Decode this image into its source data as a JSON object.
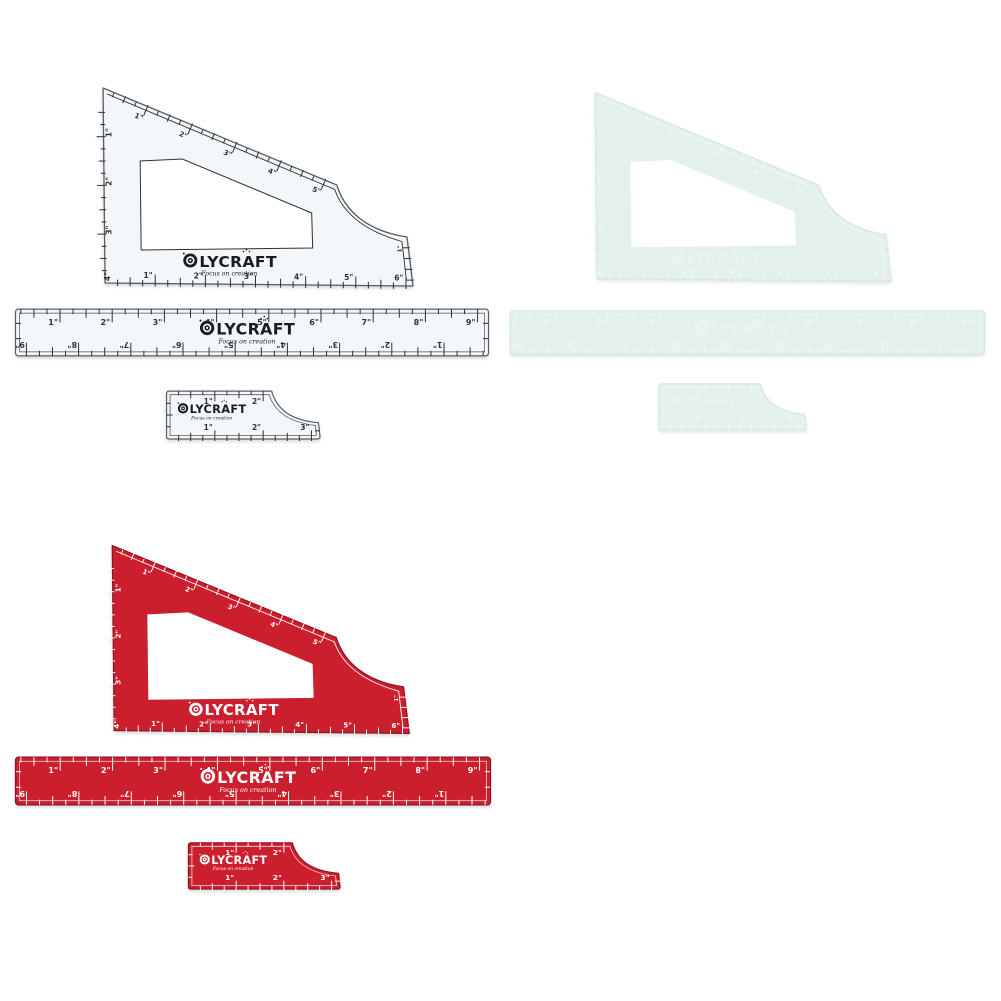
{
  "background": "#ffffff",
  "brand": {
    "name": "OLYCRAFT",
    "tagline": "Focus on creation"
  },
  "sets": [
    {
      "variant": "white",
      "fill": "#f4f7fa",
      "edge_color": "#5a5e65",
      "mark_color": "#2e3136",
      "logo_color": "#1b1c1f",
      "mark_opacity": 1
    },
    {
      "variant": "mint",
      "fill": "#e4f1ea",
      "edge_color": "#d3e8dd",
      "mark_color": "#ffffff",
      "logo_color": "#f3faf6",
      "mark_opacity": 0.5
    },
    {
      "variant": "red",
      "fill": "#cb1f2e",
      "edge_color": "#8f1320",
      "mark_color": "#ffffff",
      "logo_color": "#ffffff",
      "mark_opacity": 1
    }
  ],
  "triangle_ruler": {
    "hypotenuse_labels": [
      "1\"",
      "2\"",
      "3\"",
      "4\"",
      "5\""
    ],
    "left_labels": [
      "1\"",
      "2\"",
      "3\"",
      "4\""
    ],
    "bottom_labels": [
      "1\"",
      "2\"",
      "3\"",
      "4\"",
      "5\"",
      "6\""
    ],
    "right_edge_label": "1\""
  },
  "long_ruler": {
    "top_labels": [
      "1\"",
      "2\"",
      "3\"",
      "4\"",
      "5\"",
      "6\"",
      "7\"",
      "8\"",
      "9\""
    ],
    "bottom_labels_inverted": [
      "9\"",
      "8\"",
      "7\"",
      "6\"",
      "5\"",
      "4\"",
      "3\"",
      "2\"",
      "1\""
    ]
  },
  "small_ruler": {
    "top_labels": [
      "1\"",
      "2\""
    ],
    "bottom_labels": [
      "1\"",
      "2\"",
      "3\""
    ]
  }
}
